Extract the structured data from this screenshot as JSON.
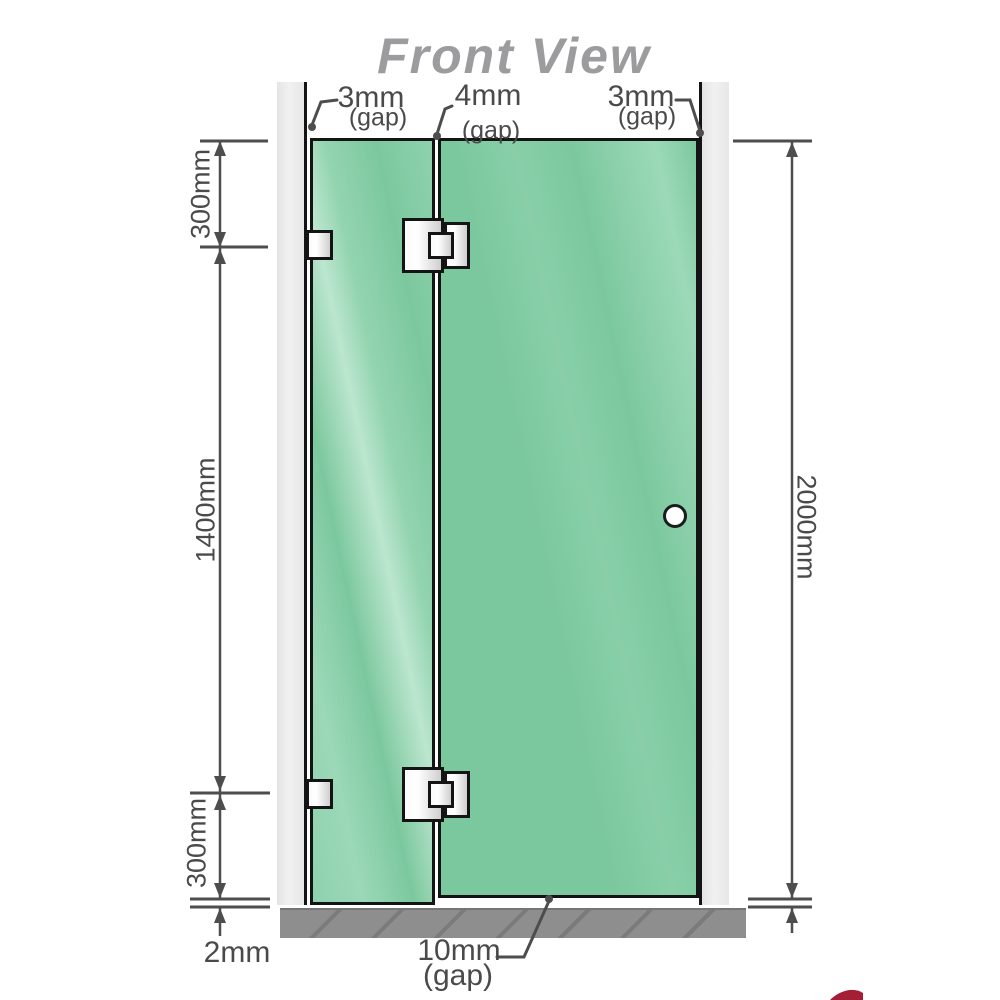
{
  "title": "Front View",
  "labels": {
    "gap_top_left": {
      "value": "3mm",
      "note": "(gap)"
    },
    "gap_top_middle": {
      "value": "4mm",
      "note": "(gap)"
    },
    "gap_top_right": {
      "value": "3mm",
      "note": "(gap)"
    },
    "gap_bottom_door": {
      "value": "10mm",
      "note": "(gap)"
    },
    "gap_bottom_floor": {
      "value": "2mm"
    }
  },
  "dimensions": {
    "panel_top_to_upper_hinge": "300mm",
    "hinge_to_hinge": "1400mm",
    "lower_hinge_to_bottom": "300mm",
    "total_height": "2000mm"
  },
  "components": {
    "left_panel": "fixed-glass-panel",
    "right_panel": "hinged-glass-door",
    "hinges": "glass-to-glass-hinges",
    "brackets": "wall-to-glass-brackets",
    "handle": "round-door-knob"
  },
  "colors": {
    "glass": "#7ecb9f",
    "glass_highlight": "#bce6cf",
    "wall_channel": "#ececec",
    "floor": "#8e8e8e",
    "dimension_lines": "#4d4d4d",
    "title_text": "#9c9c9e",
    "outline": "#141414",
    "logo_red": "#a41f35"
  }
}
